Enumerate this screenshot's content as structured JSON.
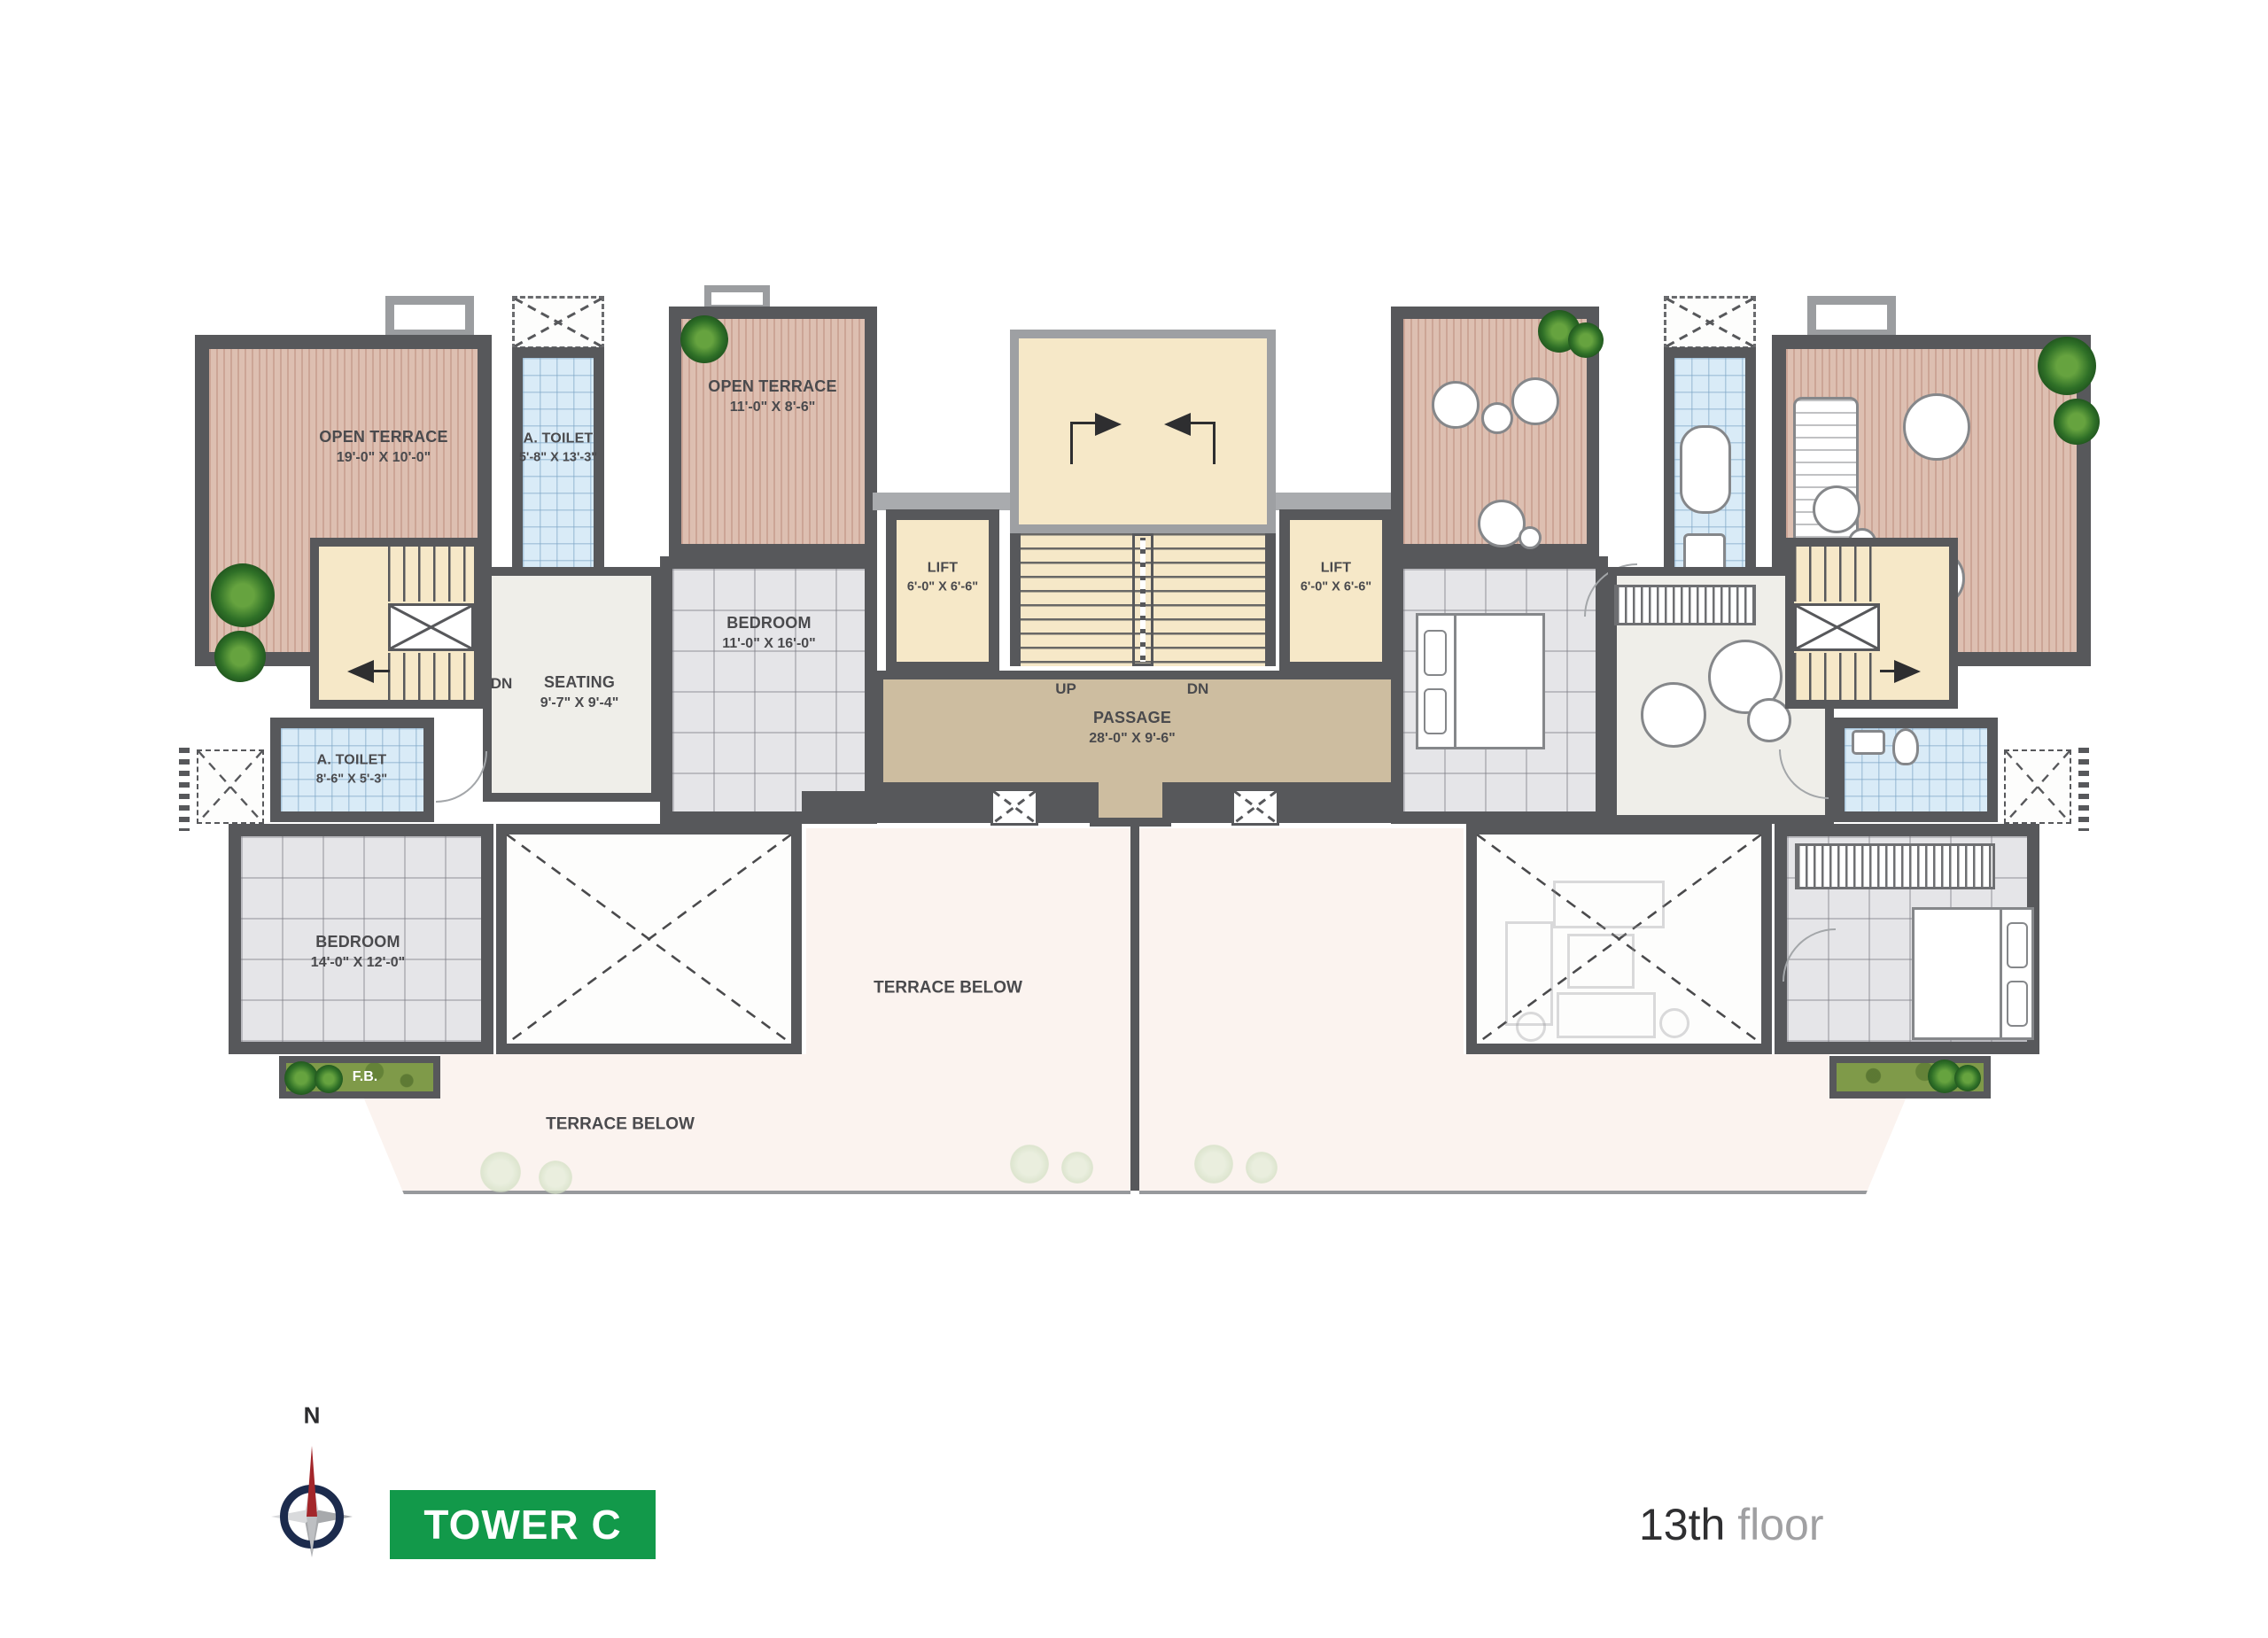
{
  "title": "Tower C - 13th floor plan",
  "rooms": {
    "open_terrace_1": {
      "name": "OPEN TERRACE",
      "dims": "19'-0\" X 10'-0\""
    },
    "a_toilet_1": {
      "name": "A. TOILET",
      "dims": "5'-8\" X 13'-3\""
    },
    "open_terrace_2": {
      "name": "OPEN TERRACE",
      "dims": "11'-0\" X 8'-6\""
    },
    "bedroom_1": {
      "name": "BEDROOM",
      "dims": "11'-0\" X 16'-0\""
    },
    "seating": {
      "name": "SEATING",
      "dims": "9'-7\" X 9'-4\""
    },
    "a_toilet_2": {
      "name": "A. TOILET",
      "dims": "8'-6\" X 5'-3\""
    },
    "bedroom_2": {
      "name": "BEDROOM",
      "dims": "14'-0\" X 12'-0\""
    },
    "lift_left": {
      "name": "LIFT",
      "dims": "6'-0\" X 6'-6\""
    },
    "lift_right": {
      "name": "LIFT",
      "dims": "6'-0\" X 6'-6\""
    },
    "passage": {
      "name": "PASSAGE",
      "dims": "28'-0\" X 9'-6\""
    }
  },
  "annotations": {
    "up": "UP",
    "dn": "DN",
    "dn_left": "DN",
    "flower_bed": "F.B.",
    "terrace_below_left": "TERRACE BELOW",
    "terrace_below_center": "TERRACE BELOW"
  },
  "footer": {
    "compass_north": "N",
    "tower_badge": "TOWER C",
    "floor_number": "13th",
    "floor_word": "floor"
  },
  "colors": {
    "wall_dark": "#57585B",
    "deck_pink": "#DDBFB1",
    "toilet_blue": "#D9EBF7",
    "stair_cream": "#F6E8C8",
    "passage_tan": "#CDBDA0",
    "flower_bed_green": "#7F9A49",
    "badge_green": "#12994A",
    "compass_navy": "#1C2B4D",
    "compass_red": "#A3262A"
  }
}
